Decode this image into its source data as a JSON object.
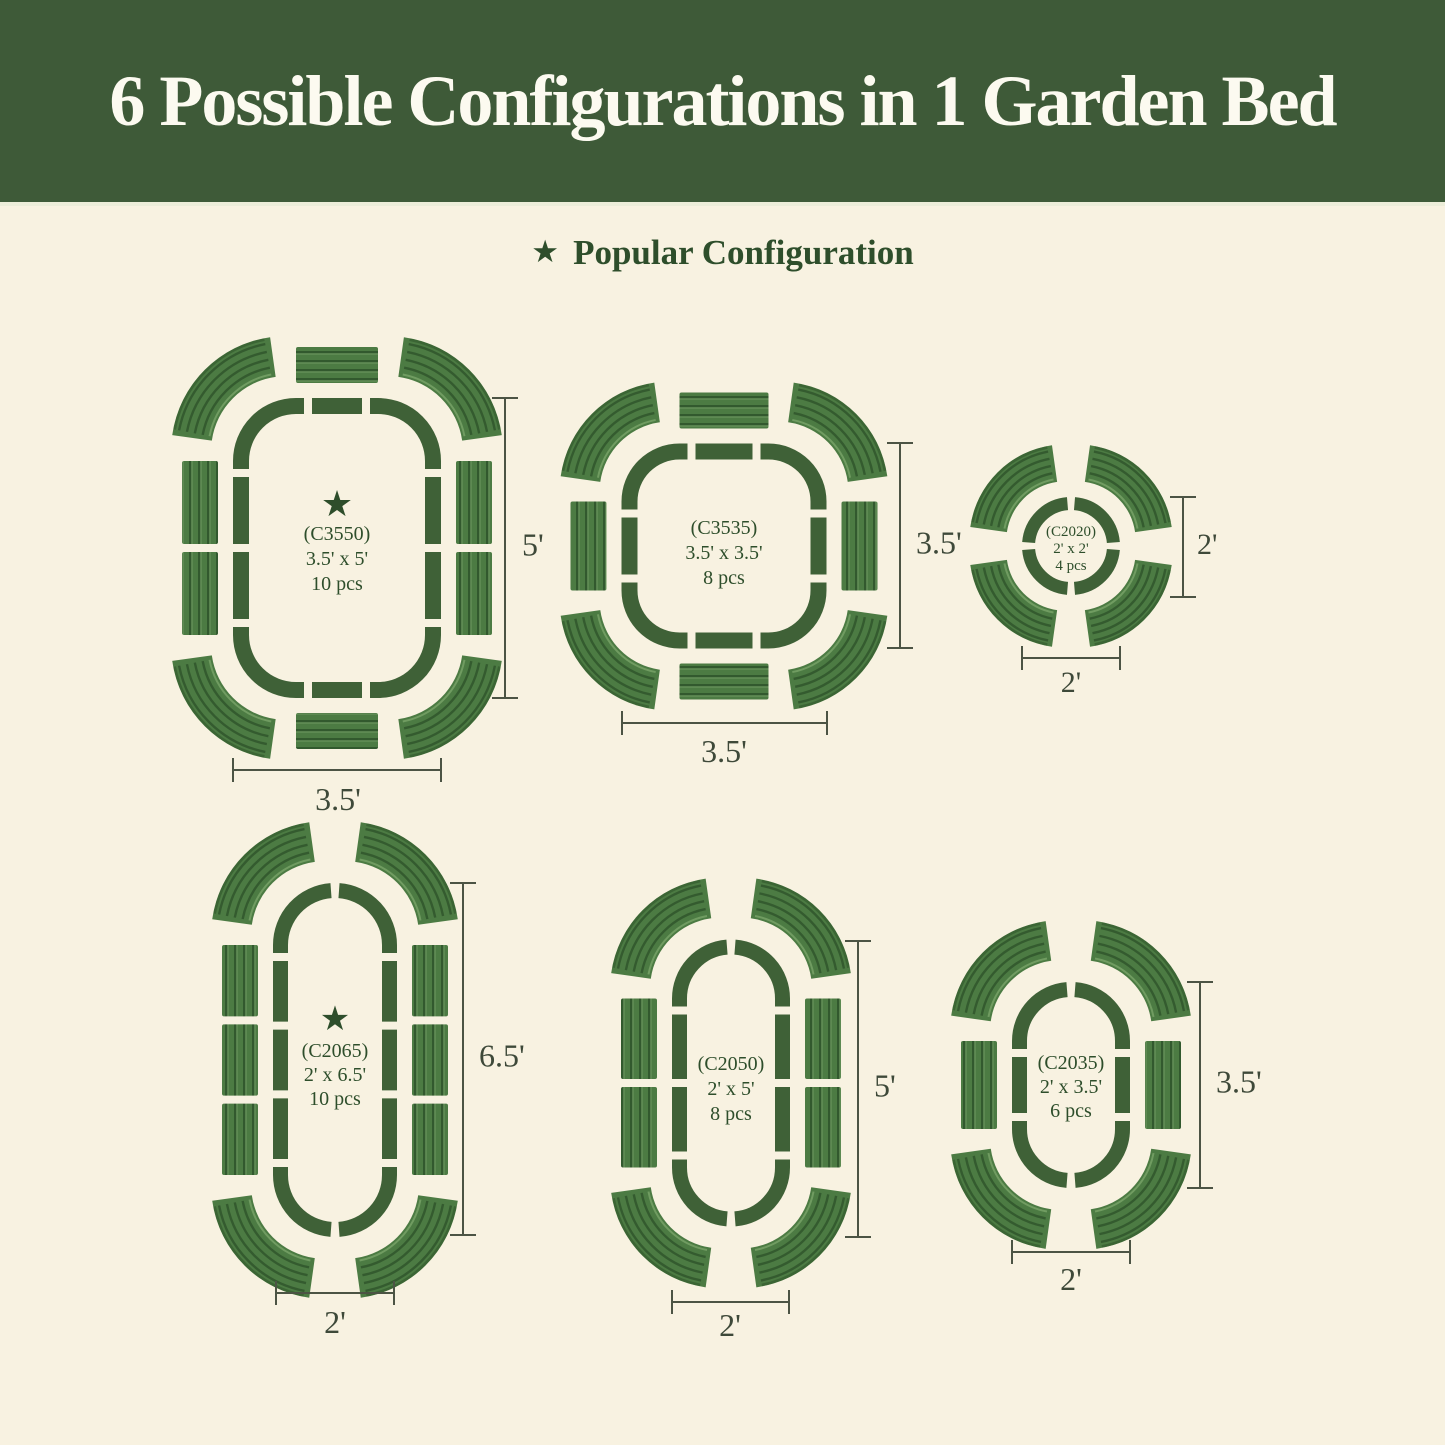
{
  "header": {
    "title": "6 Possible Configurations in 1 Garden Bed"
  },
  "legend": {
    "label": "Popular Configuration"
  },
  "symbols": {
    "star": "★"
  },
  "colors": {
    "banner_bg": "#3E5A38",
    "banner_text": "#FCFAF0",
    "banner_edge": "#ECEDD9",
    "page_bg": "#F8F2E1",
    "ring": "#3F6137",
    "panel_base": "#4C7B43",
    "panel_stripe": "#30562B",
    "panel_light": "#74A065",
    "text_green": "#2E4E2B",
    "dim_line": "#4C5444",
    "dim_text": "#3E4939"
  },
  "configs": [
    {
      "id": "(C3550)",
      "size": "3.5' x 5'",
      "pcs": "10 pcs",
      "popular": true,
      "dim_right": "5'",
      "dim_bottom": "3.5'",
      "shape": "rounded-rectangle",
      "pieces": {
        "corners": 4,
        "top": 1,
        "bottom": 1,
        "left": 2,
        "right": 2
      }
    },
    {
      "id": "(C3535)",
      "size": "3.5' x 3.5'",
      "pcs": "8 pcs",
      "popular": false,
      "dim_right": "3.5'",
      "dim_bottom": "3.5'",
      "shape": "rounded-square",
      "pieces": {
        "corners": 4,
        "top": 1,
        "bottom": 1,
        "left": 1,
        "right": 1
      }
    },
    {
      "id": "(C2020)",
      "size": "2' x 2'",
      "pcs": "4 pcs",
      "popular": false,
      "dim_right": "2'",
      "dim_bottom": "2'",
      "shape": "circle",
      "pieces": {
        "corners": 4,
        "top": 0,
        "bottom": 0,
        "left": 0,
        "right": 0
      }
    },
    {
      "id": "(C2065)",
      "size": "2' x 6.5'",
      "pcs": "10 pcs",
      "popular": true,
      "dim_right": "6.5'",
      "dim_bottom": "2'",
      "shape": "oval",
      "pieces": {
        "corners": 4,
        "top": 0,
        "bottom": 0,
        "left": 3,
        "right": 3
      }
    },
    {
      "id": "(C2050)",
      "size": "2' x 5'",
      "pcs": "8 pcs",
      "popular": false,
      "dim_right": "5'",
      "dim_bottom": "2'",
      "shape": "oval",
      "pieces": {
        "corners": 4,
        "top": 0,
        "bottom": 0,
        "left": 2,
        "right": 2
      }
    },
    {
      "id": "(C2035)",
      "size": "2' x 3.5'",
      "pcs": "6 pcs",
      "popular": false,
      "dim_right": "3.5'",
      "dim_bottom": "2'",
      "shape": "oval",
      "pieces": {
        "corners": 4,
        "top": 0,
        "bottom": 0,
        "left": 1,
        "right": 1
      }
    }
  ]
}
